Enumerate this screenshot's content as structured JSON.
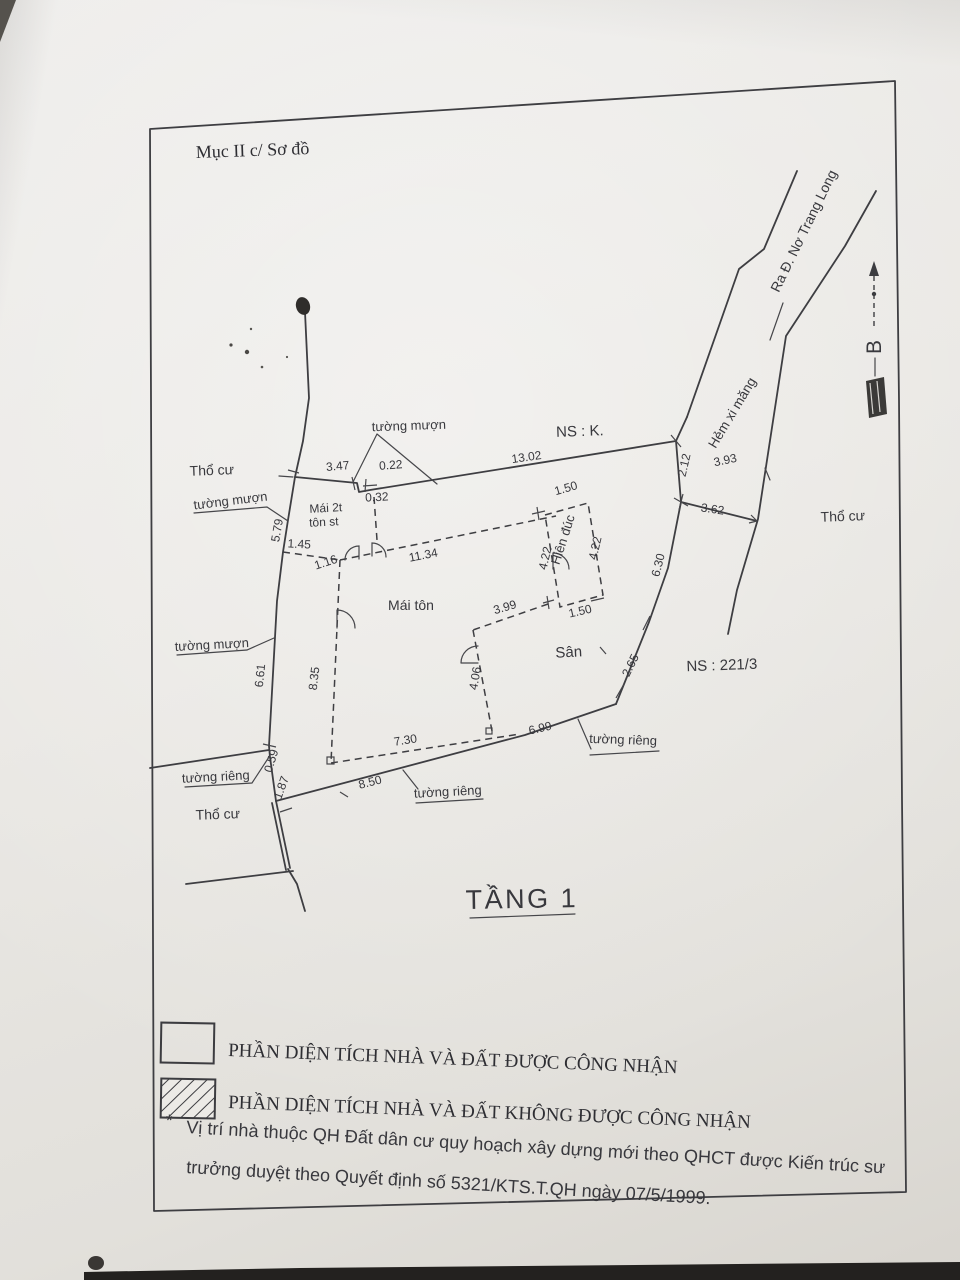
{
  "page": {
    "section_title": "Mục II c/ Sơ đồ",
    "floor_title": "TẦNG 1"
  },
  "compass": {
    "north_label": "B"
  },
  "roads": {
    "main_road": "Ra Đ. Nơ Trang Long",
    "alley": "Hẻm xi măng"
  },
  "parcels": {
    "ns_top": "NS : K.",
    "ns_right": "NS : 221/3",
    "land_top_left": "Thổ cư",
    "land_right": "Thổ cư",
    "land_bottom_left": "Thổ cư"
  },
  "features": {
    "roof_main": "Mái tôn",
    "roof_small_line1": "Mái 2t",
    "roof_small_line2": "tôn st",
    "yard": "Sân",
    "porch": "Hiên đúc"
  },
  "walls": {
    "borrowed_top": "tường mượn",
    "borrowed_left_upper": "tường mượn",
    "borrowed_left_mid": "tường mượn",
    "private_left": "tường riêng",
    "private_bottom": "tường riêng",
    "private_right": "tường riêng"
  },
  "dimensions": {
    "top": {
      "seg_347": "3.47",
      "jog_022": "0.22",
      "jog_032": "0.32",
      "seg_1302": "13.02"
    },
    "right": {
      "d212": "2.12",
      "alley_393": "3.93",
      "alley_362": "3.62",
      "d630": "6.30",
      "d265": "2.65"
    },
    "bottom": {
      "d850": "8.50",
      "d699": "6.99"
    },
    "left": {
      "d579": "5.79",
      "d661": "6.61",
      "d059": "0.59",
      "d187": "1.87"
    },
    "house": {
      "d145": "1.45",
      "d116": "1.16",
      "d1134": "11.34",
      "d835": "8.35",
      "d730": "7.30",
      "d399": "3.99",
      "d406": "4.06"
    },
    "porch": {
      "top_150": "1.50",
      "bottom_150": "1.50",
      "left_422": "4.22",
      "right_422": "4.22"
    }
  },
  "legend": {
    "recognized": "PHẦN DIỆN TÍCH NHÀ VÀ ĐẤT ĐƯỢC CÔNG NHẬN",
    "not_recognized": "PHẦN DIỆN TÍCH NHÀ VÀ ĐẤT KHÔNG ĐƯỢC CÔNG NHẬN"
  },
  "note": {
    "marker": "*",
    "line1": "Vị trí nhà thuộc QH Đất dân cư quy hoạch xây dựng mới theo QHCT được Kiến trúc sư",
    "line2": "trưởng duyệt theo Quyết định số 5321/KTS.T.QH ngày 07/5/1999."
  }
}
